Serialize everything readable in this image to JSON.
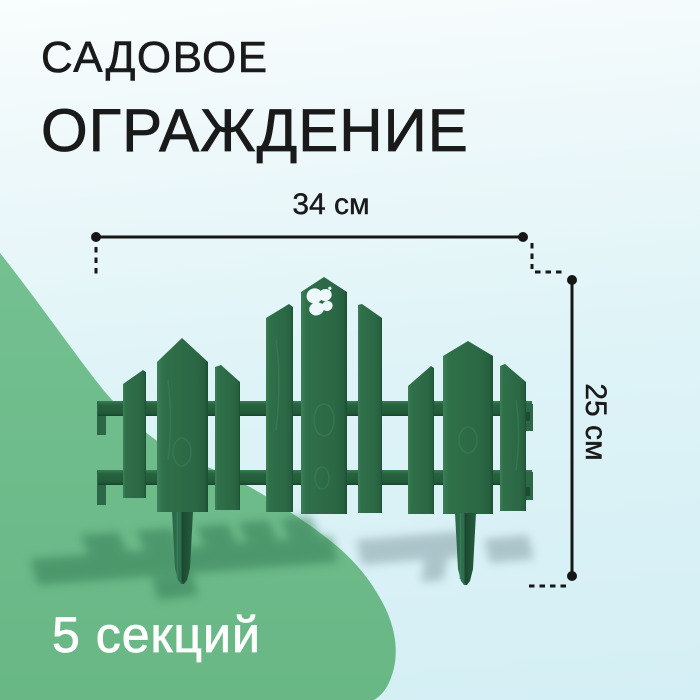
{
  "card": {
    "title_line1": "САДОВОЕ",
    "title_line2": "ОГРАЖДЕНИЕ",
    "width_dimension_label": "34 см",
    "height_dimension_label": "25 см",
    "sections_label": "5 секций"
  },
  "icons": {
    "butterfly_cutout": "butterfly-icon"
  },
  "colors": {
    "background_top": "#f9fdfd",
    "background_bottom": "#d4eff5",
    "blob_green": "#6fbc8b",
    "fence_green": "#2d6b47",
    "dimension_line": "#161616",
    "title_text": "#1a1a1a",
    "footer_text": "#ffffff"
  }
}
